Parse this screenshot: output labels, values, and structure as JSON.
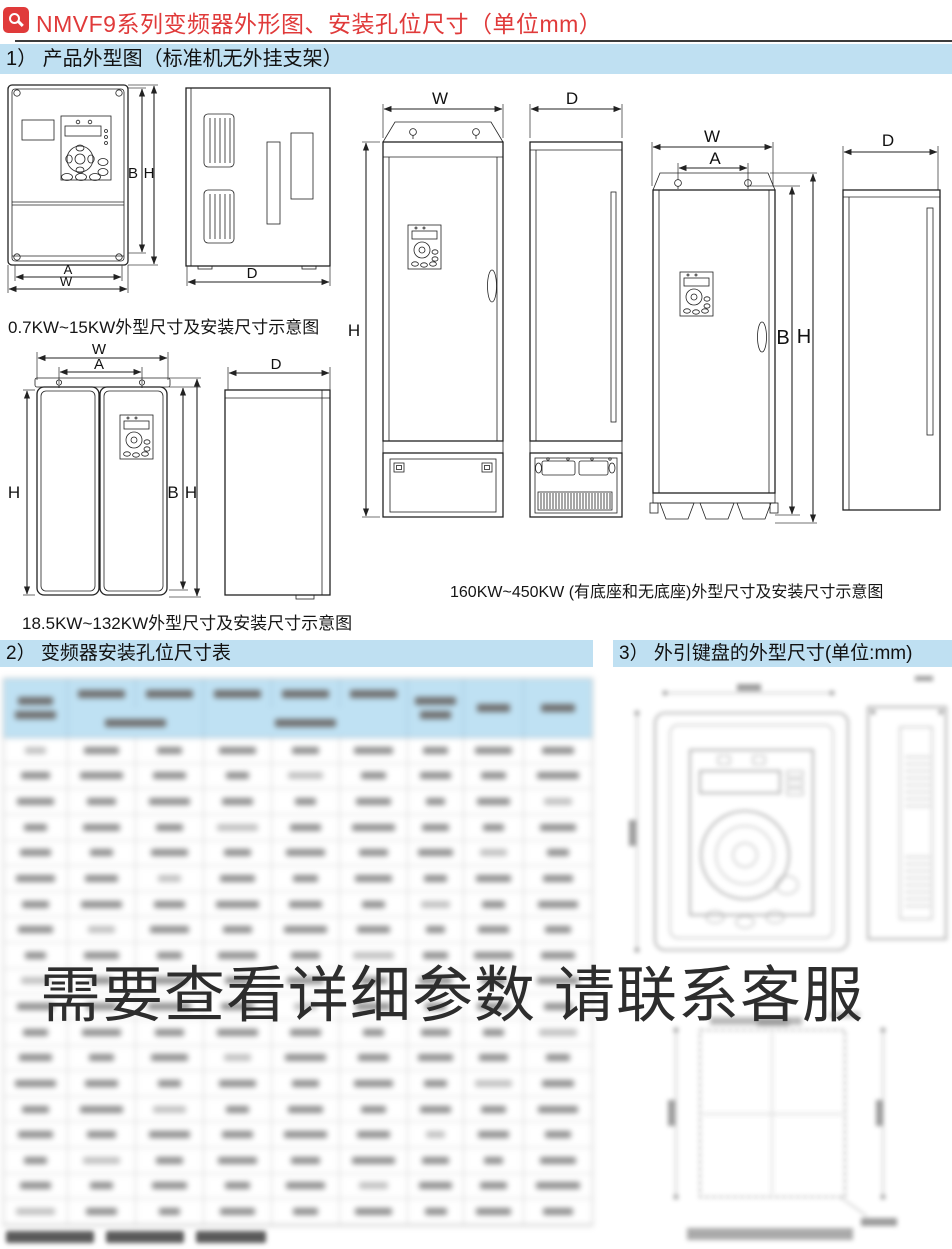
{
  "header": {
    "icon": "magnifier-icon",
    "title": "NMVF9系列变频器外形图、安装孔位尺寸（单位mm）"
  },
  "sections": {
    "one": "1） 产品外型图（标准机无外挂支架）",
    "two": "2） 变频器安装孔位尺寸表",
    "three": "3） 外引键盘的外型尺寸(单位:mm)"
  },
  "captions": {
    "small_range": "0.7KW~15KW外型尺寸及安装尺寸示意图",
    "medium_range": "18.5KW~132KW外型尺寸及安装尺寸示意图",
    "large_range": "160KW~450KW (有底座和无底座)外型尺寸及安装尺寸示意图"
  },
  "dim_labels": {
    "W": "W",
    "A": "A",
    "B": "B",
    "H": "H",
    "D": "D"
  },
  "watermark": {
    "text": "需要查看详细参数 请联系客服",
    "color": "#2d2d2d"
  },
  "colors": {
    "accent_red": "#e03a3a",
    "section_bar": "#bfe0f2",
    "table_header": "#bfe1f3",
    "drawing_line": "#222222"
  },
  "blurred_table": {
    "blurred": true,
    "rows": 19,
    "columns": 9
  }
}
